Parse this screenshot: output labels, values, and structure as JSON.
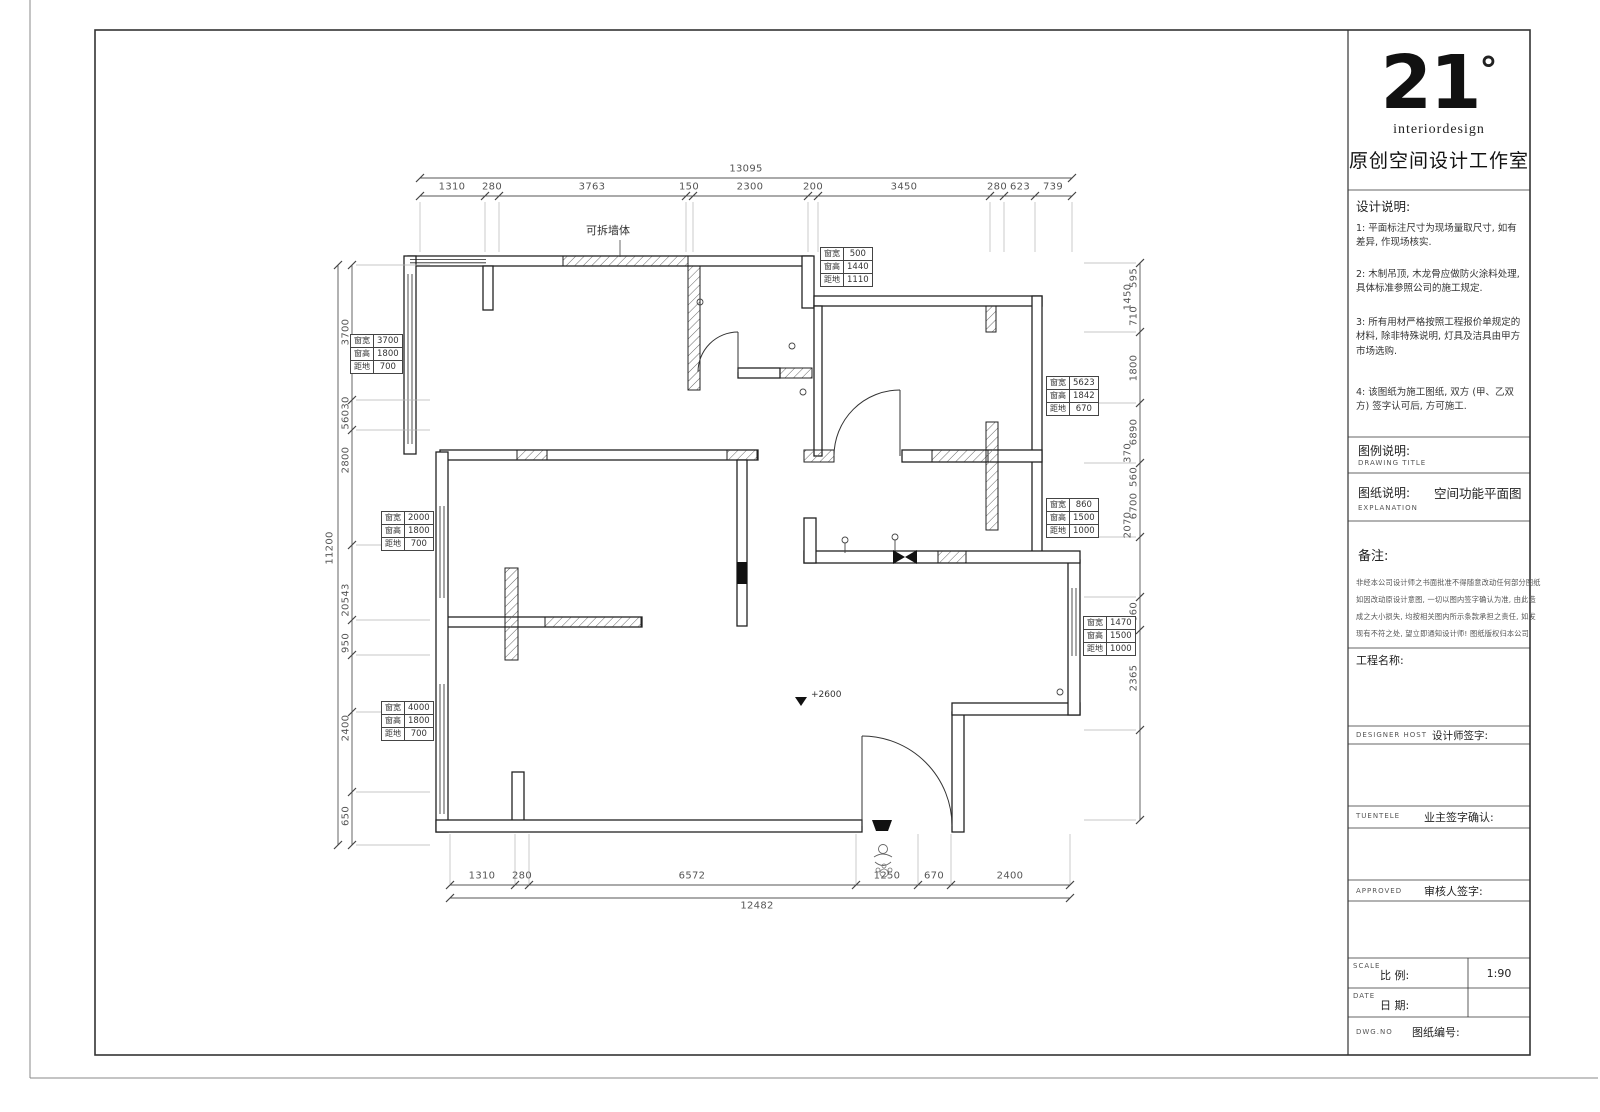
{
  "title_block": {
    "logo": {
      "number": "21",
      "degree": "°",
      "sub_en": "interiordesign",
      "studio": "原创空间设计工作室"
    },
    "design_notes": {
      "title": "设计说明:",
      "items": [
        "1: 平面标注尺寸为现场量取尺寸, 如有差异, 作现场核实.",
        "2: 木制吊顶, 木龙骨应做防火涂料处理, 具体标准参照公司的施工规定.",
        "3: 所有用材严格按照工程报价单规定的材料, 除非特殊说明, 灯具及洁具由甲方市场选购.",
        "4: 该图纸为施工图纸, 双方 (甲、乙双方) 签字认可后, 方可施工."
      ]
    },
    "legend": {
      "label": "图例说明:",
      "label_en": "DRAWING TITLE"
    },
    "sheet": {
      "label": "图纸说明:",
      "value": "空间功能平面图",
      "label_en": "EXPLANATION"
    },
    "remarks": {
      "title": "备注:",
      "lines": [
        "非经本公司设计师之书面批准不得随意改动任何部分图纸",
        "如因改动原设计意图, 一切以图内签字确认为准, 由此造",
        "成之大小损失, 均按相关图内所示条款承担之责任, 如发",
        "现有不符之处, 望立即通知设计师! 图纸版权归本公司"
      ]
    },
    "project": {
      "label": "工程名称:"
    },
    "designer": {
      "label_en": "DESIGNER  HOST",
      "label": "设计师签字:"
    },
    "client": {
      "label_en": "TUENTELE",
      "label": "业主签字确认:"
    },
    "approved": {
      "label_en": "APPROVED",
      "label": "审核人签字:"
    },
    "scale": {
      "label_en": "SCALE",
      "label": "比  例:",
      "value": "1:90"
    },
    "date": {
      "label_en": "DATE",
      "label": "日  期:"
    },
    "dwg": {
      "label_en": "DWG.NO",
      "label": "图纸编号:"
    }
  },
  "plan": {
    "removable_wall_label": "可拆墙体",
    "level_marker": "+2600",
    "dims": {
      "top_total": "13095",
      "top": [
        "1310",
        "280",
        "3763",
        "150",
        "2300",
        "200",
        "3450",
        "280",
        "623",
        "739"
      ],
      "bottom": [
        "1310",
        "280",
        "6572",
        "1250",
        "670",
        "2400"
      ],
      "bottom_total": "12482",
      "left_total": "11200",
      "left": [
        "3700",
        "56030",
        "2800",
        "20543",
        "950",
        "2400",
        "650"
      ],
      "right": [
        "595",
        "1450",
        "710",
        "1800",
        "6890",
        "370",
        "560",
        "6700",
        "2070",
        "660",
        "2365"
      ]
    },
    "windows": {
      "row_labels": [
        "窗宽",
        "窗高",
        "距地"
      ],
      "tables": [
        {
          "values": [
            "3700",
            "1800",
            "700"
          ]
        },
        {
          "values": [
            "2000",
            "1800",
            "700"
          ]
        },
        {
          "values": [
            "4000",
            "1800",
            "700"
          ]
        },
        {
          "values": [
            "500",
            "1440",
            "1110"
          ]
        },
        {
          "values": [
            "5623",
            "1842",
            "670"
          ]
        },
        {
          "values": [
            "860",
            "1500",
            "1000"
          ]
        },
        {
          "values": [
            "1470",
            "1500",
            "1000"
          ]
        }
      ]
    }
  }
}
